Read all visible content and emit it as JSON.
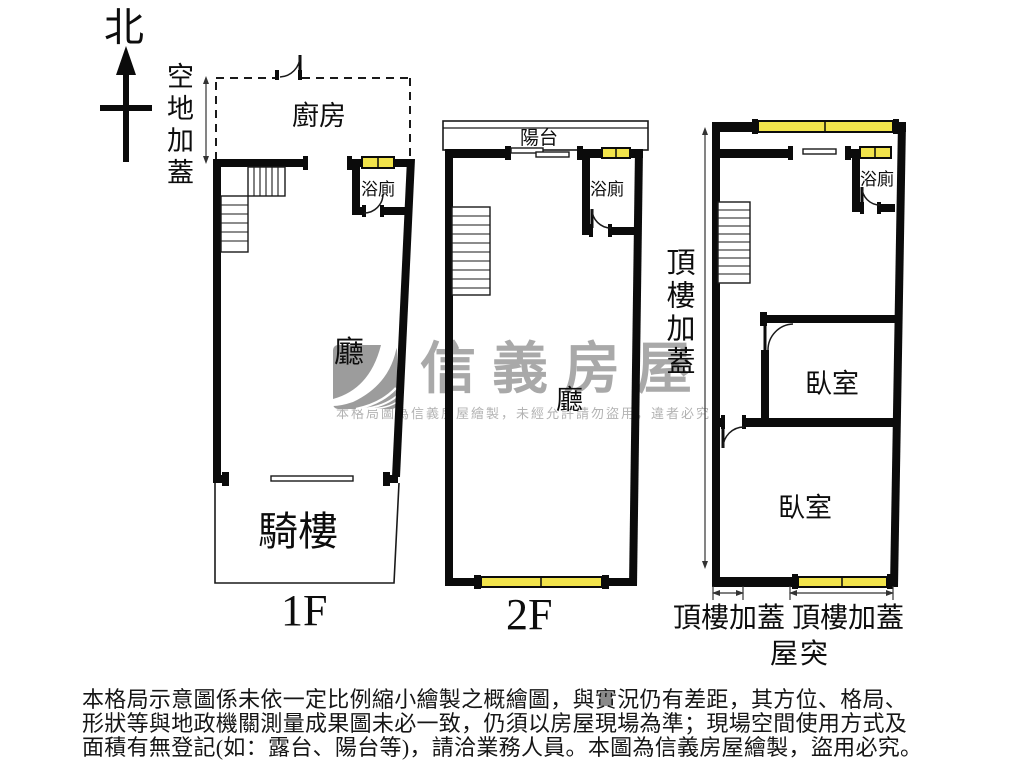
{
  "colors": {
    "wall": "#0b0b0b",
    "window_fill": "#f1e34b",
    "watermark": "#a9a9a9",
    "watermark_small": "#b3b3b3"
  },
  "compass": {
    "north_label": "北"
  },
  "floor1": {
    "open_space_annotation": "空地加蓋",
    "kitchen_label": "廚房",
    "bath_label": "浴廁",
    "living_label": "廳",
    "arcade_label": "騎樓",
    "floor_label": "1F"
  },
  "floor2": {
    "balcony_label": "陽台",
    "bath_label": "浴廁",
    "living_label": "廳",
    "floor_label": "2F"
  },
  "floor3": {
    "rooftop_annotation": "頂樓加蓋",
    "bath_label": "浴廁",
    "bedroom_upper_label": "臥室",
    "bedroom_lower_label": "臥室",
    "dim_left_label": "頂樓加蓋",
    "dim_right_label": "頂樓加蓋",
    "roof_protrusion_label": "屋突"
  },
  "watermark": {
    "brand": "信義房屋",
    "notice": "本格局圖為信義房屋繪製，未經允許請勿盜用，違者必究"
  },
  "disclaimer": {
    "line1": "本格局示意圖係未依一定比例縮小繪製之概繪圖，與實況仍有差距，其方位、格局、",
    "line2": "形狀等與地政機關測量成果圖未必一致，仍須以房屋現場為準；現場空間使用方式及",
    "line3": "面積有無登記(如：露台、陽台等)，請洽業務人員。本圖為信義房屋繪製，盜用必究。"
  }
}
